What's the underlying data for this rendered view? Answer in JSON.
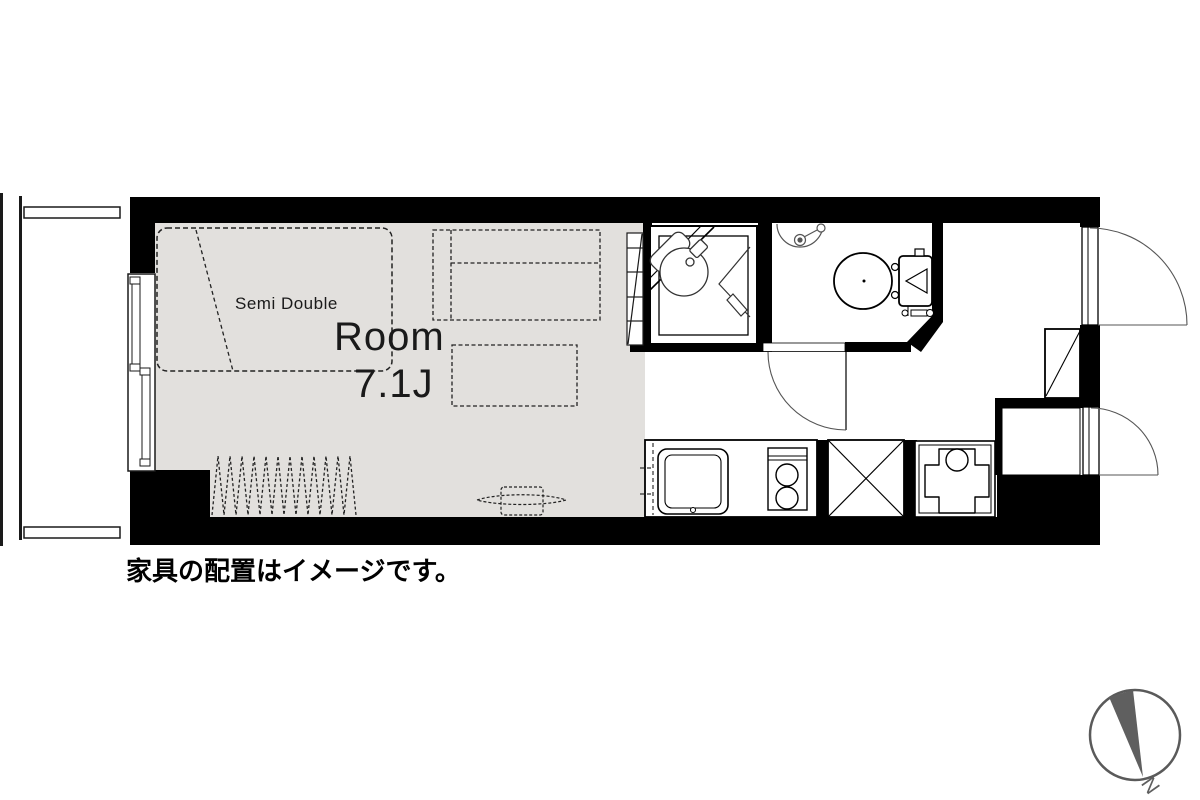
{
  "floor_plan": {
    "labels": {
      "bed": "Semi Double",
      "room_name": "Room",
      "room_size": "7.1J",
      "caption": "家具の配置はイメージです。",
      "compass_north": "N"
    },
    "rooms": [
      {
        "name": "Room",
        "size": "7.1J"
      }
    ],
    "fixtures": [
      "semi-double-bed",
      "sofa",
      "low-table",
      "rug",
      "tv",
      "tall-shelf",
      "shower-unit",
      "corner-basin",
      "folding-door",
      "wall-basin",
      "toilet",
      "toilet-door",
      "kitchen-counter",
      "kitchen-sink",
      "two-burner-stove",
      "appliance-space",
      "washing-machine-pan",
      "shoe-cabinet",
      "storage-room",
      "entrance-door",
      "storage-door",
      "sliding-window",
      "balcony-partitions",
      "compass"
    ],
    "colors": {
      "floor": "#e2e0dd",
      "wall": "#000000",
      "outline": "#1a1a1a",
      "door_arc": "#555555",
      "compass": "#5f5f5f"
    }
  }
}
